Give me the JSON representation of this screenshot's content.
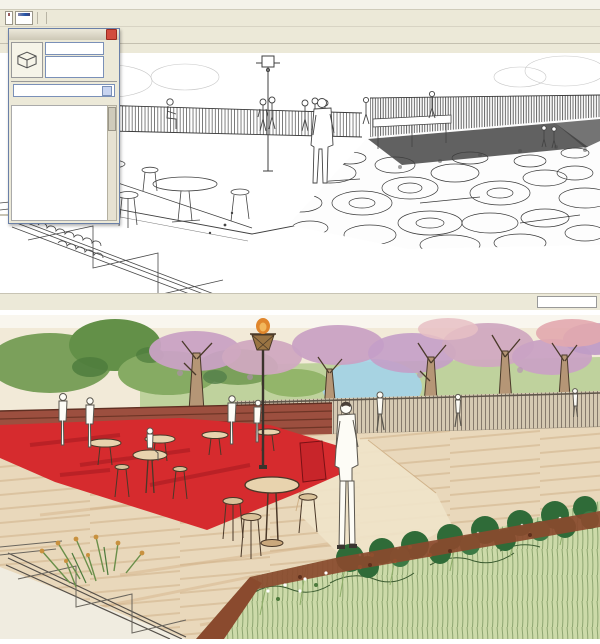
{
  "window": {
    "menu": {
      "items": [
        "File",
        "Edit",
        "View",
        "Camera",
        "Draw",
        "Tools",
        "Window",
        "Plugins",
        "Help"
      ]
    },
    "toolbar_shadow": {
      "icons": [
        {
          "name": "shadow-dialog-icon",
          "glyph": "◐",
          "color": "#4a4a4a"
        },
        {
          "name": "shadow-toggle-icon",
          "glyph": "◑",
          "color": "#4a4a4a"
        }
      ],
      "months": "J F M A M J J A S O N D",
      "time_start": "06:38 AM",
      "time_noon": "Noon",
      "time_end": "04:33 PM"
    },
    "toolbar_sandbox": {
      "icons": [
        {
          "name": "sandbox-from-contours-icon",
          "glyph": "◣",
          "color": "#8a6f4f"
        },
        {
          "name": "sandbox-from-scratch-icon",
          "glyph": "▦",
          "color": "#8a6f4f"
        },
        {
          "name": "smoove-icon",
          "glyph": "◆",
          "color": "#8a6f4f"
        },
        {
          "name": "stamp-icon",
          "glyph": "◈",
          "color": "#8a6f4f"
        },
        {
          "name": "drape-icon",
          "glyph": "▨",
          "color": "#8a6f4f"
        },
        {
          "name": "add-detail-icon",
          "glyph": "▲",
          "color": "#8a6f4f"
        },
        {
          "name": "flip-edge-icon",
          "glyph": "▽",
          "color": "#8a6f4f"
        }
      ]
    },
    "toolbar_skinx": {
      "label": "SkinX / YBub",
      "label_color": "#cc2222",
      "icons": [
        {
          "name": "skinx-skin-icon",
          "glyph": "◗",
          "color": "#2a52b0"
        },
        {
          "name": "skinx-bubble-icon",
          "glyph": "◖",
          "color": "#2a52b0"
        },
        {
          "name": "skinx-wave-icon",
          "glyph": "◗",
          "color": "#2a52b0"
        },
        {
          "name": "play-animation-icon",
          "glyph": "▶",
          "color": "#111111"
        },
        {
          "name": "record-animation-icon",
          "glyph": "■",
          "color": "#cc2222"
        },
        {
          "name": "help-question-icon",
          "glyph": "?",
          "color": "#2244bb"
        },
        {
          "name": "cone-tool-icon",
          "glyph": "▲",
          "color": "#7a5d8f"
        }
      ]
    },
    "toolbar_main": {
      "icons": [
        {
          "name": "paint-bucket-icon",
          "glyph": "◆",
          "color": "#b8413f"
        },
        {
          "name": "move-icon",
          "glyph": "✚",
          "color": "#b8413f"
        },
        {
          "name": "rotate-icon",
          "glyph": "↻",
          "color": "#d06a2c"
        },
        {
          "name": "scale-icon",
          "glyph": "◈",
          "color": "#b8413f"
        },
        {
          "name": "offset-icon",
          "glyph": "◉",
          "color": "#b8413f"
        },
        {
          "cls": "sep"
        },
        {
          "name": "zoom-tool-icon",
          "glyph": "⊙",
          "color": "#33507d"
        },
        {
          "name": "zoom-all-icon",
          "glyph": "▣",
          "color": "#33507d"
        },
        {
          "name": "photo-match-icon",
          "glyph": "⌂",
          "color": "#7a5a3a"
        },
        {
          "cls": "sep"
        },
        {
          "name": "push-pull-icon",
          "glyph": "▲",
          "color": "#b8413f"
        },
        {
          "name": "follow-me-icon",
          "glyph": "●",
          "color": "#c07070"
        },
        {
          "name": "zoom-window-icon",
          "glyph": "⊙",
          "color": "#444444"
        },
        {
          "name": "zoom-extents-icon",
          "glyph": "✖",
          "color": "#b8413f"
        },
        {
          "cls": "sep"
        },
        {
          "name": "image-icon",
          "glyph": "▤",
          "color": "#556699"
        },
        {
          "name": "component-icon",
          "glyph": "◆",
          "color": "#a04040"
        },
        {
          "name": "group-icon",
          "glyph": "●",
          "color": "#7a3a8f"
        },
        {
          "name": "outliner-icon",
          "glyph": "◉",
          "color": "#a03333"
        },
        {
          "cls": "sep"
        },
        {
          "name": "xray-style-icon",
          "glyph": "▱",
          "color": "#8a8a8a"
        },
        {
          "name": "wireframe-style-icon",
          "glyph": "▦",
          "color": "#777777"
        },
        {
          "name": "hidden-line-style-icon",
          "glyph": "□",
          "color": "#555555",
          "cls": "selected"
        },
        {
          "name": "shaded-style-icon",
          "glyph": "■",
          "color": "#6a8ab0"
        },
        {
          "name": "shaded-textures-style-icon",
          "glyph": "▩",
          "color": "#4f5f4a"
        },
        {
          "name": "monochrome-style-icon",
          "glyph": "▤",
          "color": "#9a9a9a"
        },
        {
          "cls": "sep"
        },
        {
          "name": "texture-icon",
          "glyph": "▨",
          "color": "#8a7a5a"
        },
        {
          "name": "warehouse-icon",
          "glyph": "▦",
          "color": "#8a7a5a"
        },
        {
          "name": "house-icon",
          "glyph": "⌂",
          "color": "#555555"
        },
        {
          "name": "bed-component-icon",
          "glyph": "▤",
          "color": "#8a7a5a"
        },
        {
          "name": "house-outline-icon",
          "glyph": "⌂",
          "color": "#888888"
        },
        {
          "name": "cabinet-component-icon",
          "glyph": "▣",
          "color": "#8a7a5a"
        }
      ]
    },
    "scene_tabs": [
      {
        "label": "Scene 6"
      },
      {
        "label": "Scene 7"
      },
      {
        "label": "Scene 8"
      },
      {
        "label": "Scene 9"
      },
      {
        "label": "Scene 10"
      },
      {
        "label": "Scene 11"
      },
      {
        "label": "Scene 12"
      },
      {
        "label": "Scene 13"
      },
      {
        "label": "Scene 14"
      },
      {
        "label": "Scene 15"
      },
      {
        "label": "Scene 2"
      },
      {
        "label": "Scene 1",
        "cls": "active"
      }
    ],
    "camera_toolbar": {
      "icons": [
        {
          "name": "orbit-icon",
          "glyph": "↺",
          "color": "#c03939"
        },
        {
          "name": "pan-icon",
          "glyph": "✚",
          "color": "#8a8a8a"
        },
        {
          "name": "zoom-icon",
          "glyph": "⊙",
          "color": "#333333"
        },
        {
          "name": "zoom-window-icon",
          "glyph": "▣",
          "color": "#333333"
        },
        {
          "name": "zoom-extents-icon",
          "glyph": "✖",
          "color": "#c03939"
        },
        {
          "name": "previous-view-icon",
          "glyph": "↺",
          "color": "#999999"
        },
        {
          "name": "position-camera-icon",
          "glyph": "◉",
          "color": "#555555"
        },
        {
          "name": "look-around-icon",
          "glyph": "◎",
          "color": "#555555"
        },
        {
          "name": "walk-icon",
          "glyph": "∴",
          "color": "#333333"
        },
        {
          "name": "axes-icon",
          "glyph": "⊕",
          "color": "#555555"
        }
      ]
    },
    "status_bar": {
      "icons": [
        {
          "name": "question-status-icon",
          "glyph": "?",
          "color": "#444444"
        },
        {
          "name": "info-status-icon",
          "glyph": "i",
          "color": "#444444"
        },
        {
          "name": "user-status-icon",
          "glyph": "☻",
          "color": "#444444"
        },
        {
          "name": "model-info-icon",
          "glyph": "●",
          "color": "#ffffff",
          "cls": "blue"
        }
      ],
      "message": "Select objects. Shift to extend select. Drag mouse to select multiple.",
      "divider": "|",
      "measurements_label": "Measurements",
      "measurements_value": ""
    }
  },
  "styles_dialog": {
    "title": "Styles",
    "close_glyph": "×",
    "style_name": "Marker Super Fine",
    "style_description": "Sketchy super fine tipped marker lines.",
    "side_icons": [
      {
        "name": "create-style-icon",
        "glyph": "▦"
      },
      {
        "name": "update-style-icon",
        "glyph": "↻"
      },
      {
        "name": "paint-style-icon",
        "glyph": "✎"
      }
    ],
    "tabs": [
      {
        "label": "Select",
        "cls": "active"
      },
      {
        "label": "Edit"
      },
      {
        "label": "Mix"
      }
    ],
    "nav_icons": [
      {
        "name": "back-icon",
        "glyph": "◀"
      },
      {
        "name": "forward-icon",
        "glyph": "▶"
      },
      {
        "name": "home-icon",
        "glyph": "⌂"
      }
    ],
    "dropdown_value": "Sketchy Edges",
    "dropdown_arrow": "▾",
    "detail_icon": {
      "name": "view-detail-icon",
      "glyph": "▸"
    },
    "scroll_up": "▲",
    "scroll_down": "▼",
    "grid_cells": [
      {
        "name": "style-thumbnail"
      },
      {
        "name": "style-thumbnail"
      },
      {
        "name": "style-thumbnail"
      },
      {
        "name": "style-thumbnail"
      },
      {
        "name": "style-thumbnail",
        "cls": "dark"
      },
      {
        "name": "style-thumbnail",
        "cls": "dark"
      },
      {
        "name": "style-thumbnail"
      },
      {
        "name": "style-thumbnail"
      },
      {
        "name": "style-thumbnail"
      },
      {
        "name": "style-thumbnail"
      },
      {
        "name": "style-thumbnail"
      },
      {
        "name": "style-thumbnail"
      },
      {
        "name": "style-thumbnail"
      },
      {
        "name": "style-thumbnail"
      },
      {
        "name": "style-thumbnail"
      },
      {
        "name": "style-thumbnail"
      },
      {
        "name": "style-thumbnail"
      },
      {
        "name": "style-thumbnail"
      },
      {
        "name": "style-thumbnail"
      },
      {
        "name": "style-thumbnail"
      },
      {
        "name": "style-thumbnail"
      },
      {
        "name": "style-thumbnail"
      },
      {
        "name": "style-thumbnail"
      },
      {
        "name": "style-thumbnail"
      }
    ]
  },
  "rendering_colors": {
    "paper": "#f2ead8",
    "carpet_red": "#d62b2e",
    "deck_tan": "#e9d8bb",
    "path_tan": "#f0e4ca",
    "tree_green": "#7ba05b",
    "canopy_dark_green": "#639048",
    "blossom_purple": "#c9a2c4",
    "blossom_pink": "#e2a9ae",
    "grass_light": "#ccdaa9",
    "shrub_green": "#2f6b38",
    "soil_brown": "#8a4a2e",
    "water_blue": "#a5d2e8",
    "bench_rust": "#9c4f3f",
    "trunk_tan": "#b59676",
    "flame_orange": "#e0862c",
    "chrome": "#ece9d8",
    "scene_active_blue": "#2f8fe8"
  }
}
